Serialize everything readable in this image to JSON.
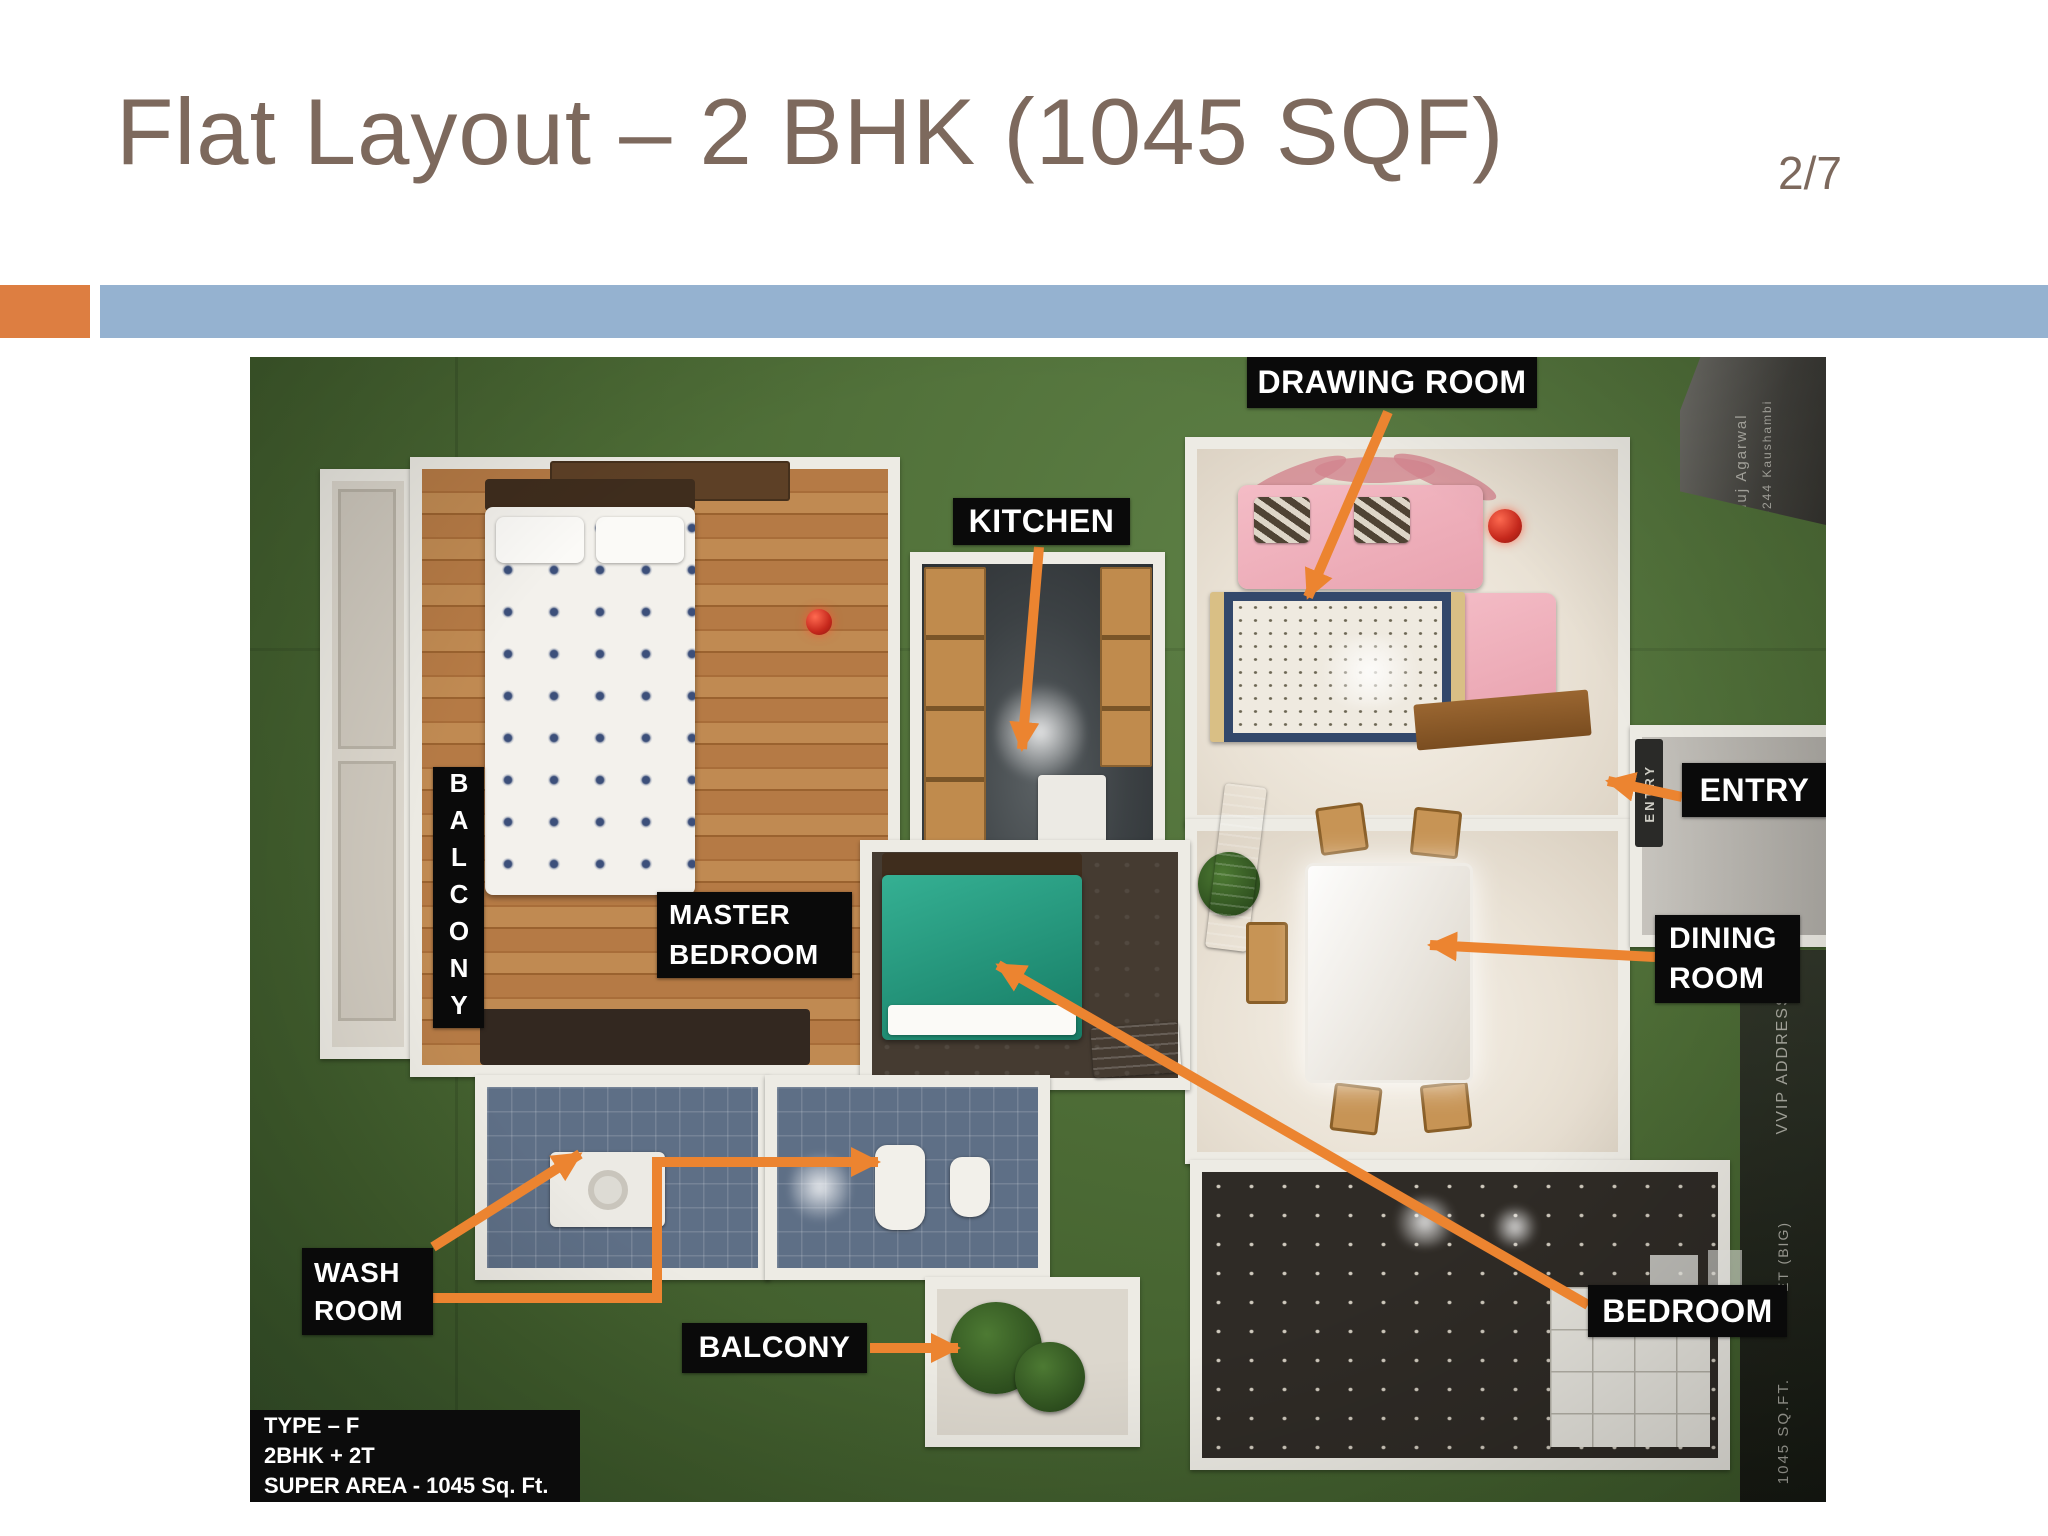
{
  "slide": {
    "title": "Flat Layout – 2 BHK (1045 SQF)",
    "page_number": "2/7"
  },
  "colors": {
    "title_brown": "#7d695d",
    "bar_orange": "#dd7e41",
    "bar_blue": "#95b2d0",
    "arrow_orange": "#ec8430",
    "label_bg": "#0a0a0a",
    "label_text": "#ffffff",
    "photo_green": "#4c6b35"
  },
  "labels": {
    "drawing_room": "DRAWING ROOM",
    "kitchen": "KITCHEN",
    "entry": "ENTRY",
    "dining_room": {
      "line1": "DINING",
      "line2": "ROOM"
    },
    "bedroom": "BEDROOM",
    "wash_room": {
      "line1": "WASH",
      "line2": "ROOM"
    },
    "master_bedroom": {
      "line1": "MASTER",
      "line2": "BEDROOM"
    },
    "balcony_bottom": "BALCONY",
    "balcony_left_vertical": "BALCONY"
  },
  "info_box": {
    "line1": "TYPE – F",
    "line2": "2BHK + 2T",
    "line3": "SUPER AREA - 1045 Sq. Ft."
  },
  "model_photo_texts": {
    "entry_wall_sticker": "ENTRY",
    "corner_plaque_line1": "Anuj Agarwal",
    "corner_plaque_line2": "A-244 Kaushambi",
    "right_edge_text_top": "VVIP ADDRESSES",
    "right_edge_text_mid": "ET (BIG)",
    "right_edge_text_bottom": "1045 SQ.FT."
  }
}
